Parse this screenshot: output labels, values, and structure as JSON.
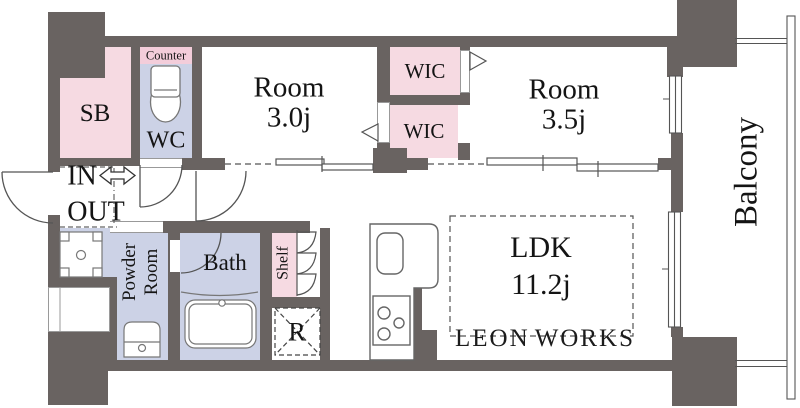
{
  "floorplan": {
    "entrance": {
      "in": "IN",
      "out": "OUT"
    },
    "rooms": {
      "sb": "SB",
      "counter": "Counter",
      "wc": "WC",
      "room_a": {
        "name": "Room",
        "size": "3.0j"
      },
      "wic_upper": "WIC",
      "wic_lower": "WIC",
      "room_b": {
        "name": "Room",
        "size": "3.5j"
      },
      "ldk": {
        "name": "LDK",
        "size": "11.2j"
      },
      "powder": {
        "line1": "Powder",
        "line2": "Room"
      },
      "bath": "Bath",
      "shelf": "Shelf",
      "refrigerator": "R",
      "balcony": "Balcony"
    },
    "watermark": {
      "word1": "LEON",
      "word2": "WORKS"
    },
    "colors": {
      "wall": "#696361",
      "room_pink": "#f6dae2",
      "counter_pink": "#f3cdda",
      "wet_area_lavender": "#ccd2e6"
    }
  }
}
